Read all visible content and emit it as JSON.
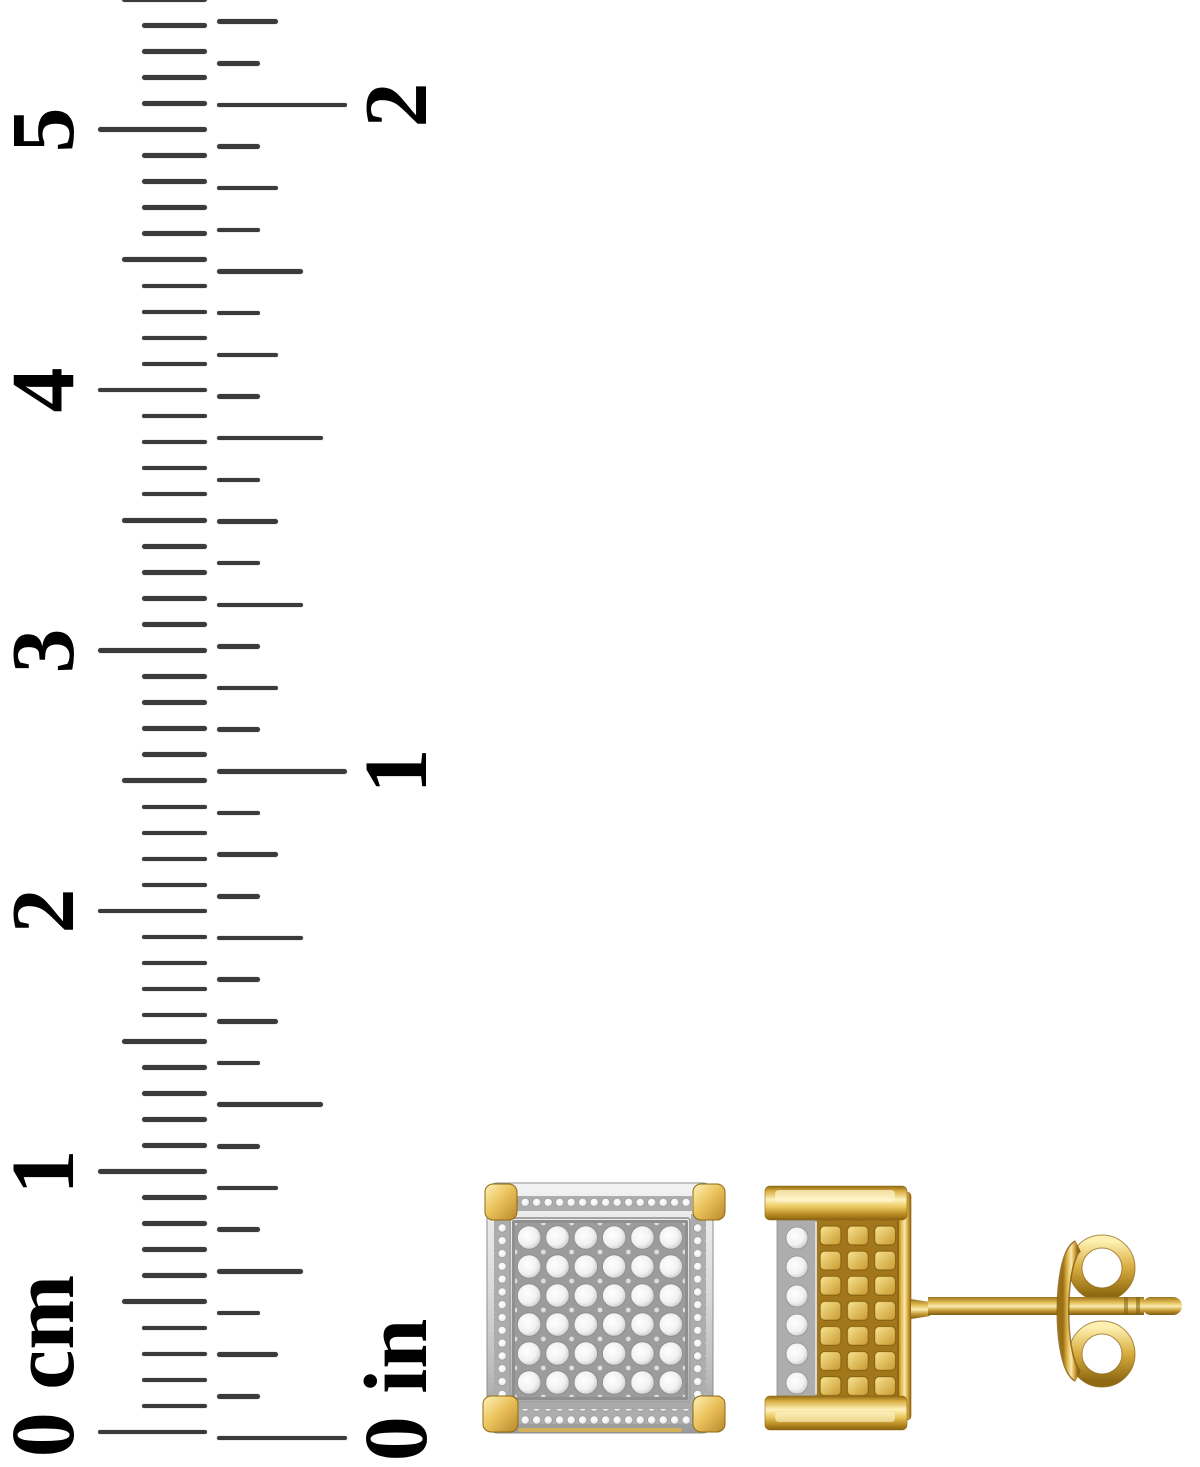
{
  "scene": {
    "background": "#ffffff"
  },
  "ruler": {
    "tick_color": "#3b3b3b",
    "label_color": "#000000",
    "tick_thickness": 4.6,
    "scales": [
      {
        "name": "cm",
        "side": "left",
        "edge_x": 207,
        "zero_y": 1432,
        "px_per_minor": 26.05,
        "minors_per_unit": 10,
        "minor_count": 56,
        "lengths": {
          "minor": 65,
          "mid": 85,
          "unit": 109
        },
        "label_x": 44,
        "zero_label_shift": 66,
        "unit_labels": [
          "0 cm",
          "1",
          "2",
          "3",
          "4",
          "5"
        ]
      },
      {
        "name": "in",
        "side": "right",
        "edge_x": 217,
        "zero_y": 1438,
        "px_per_minor": 41.66,
        "minors_per_unit": 16,
        "minor_count": 35,
        "lengths": {
          "minor": 43,
          "eighth": 61,
          "quarter": 86,
          "half": 106,
          "unit": 130
        },
        "label_x": 397,
        "zero_label_shift": 48,
        "unit_labels": [
          "0 in",
          "1",
          "2"
        ]
      }
    ]
  },
  "earrings": {
    "metal_color": "#e3b94e",
    "metal_highlight": "#fdf3c4",
    "metal_shadow": "#8a6210",
    "diamond_color": "#f1f1f1",
    "setting_color": "#b5b5b5",
    "front_view": {
      "pave_columns": 6,
      "pave_rows": 6,
      "corner_prongs": 4
    },
    "side_view": {
      "edge_diamond_count": 6,
      "texture_rows": 7,
      "texture_columns": 3
    },
    "post": {
      "groove_count": 2
    },
    "clutch": {
      "loop_count": 2
    }
  }
}
